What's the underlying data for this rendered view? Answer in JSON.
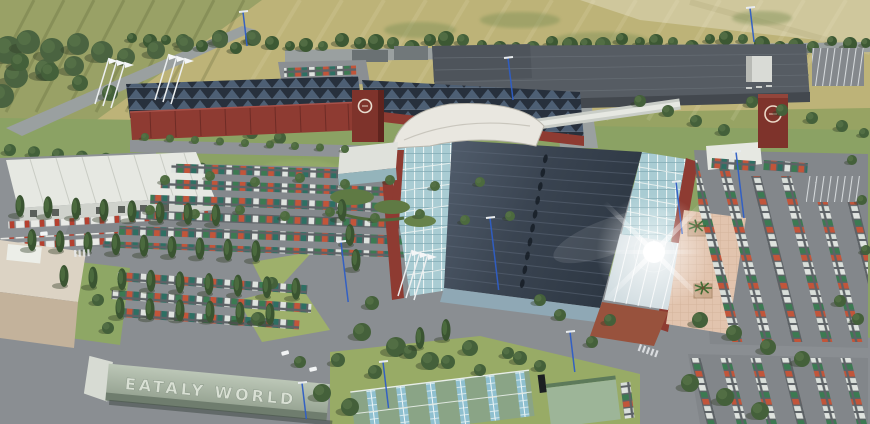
{
  "scene": {
    "sign": {
      "text": "EATALY WORLD"
    },
    "branding": {
      "tower_logo_left": "circular-ring-logo",
      "tower_logo_right": "circular-ring-logo"
    },
    "palette": {
      "field_yellow": "#bdb378",
      "field_pale": "#cfc79c",
      "field_olive": "#99a166",
      "grass": "#8ba264",
      "tree_dark": "#3f5a35",
      "road_gray": "#8a8e92",
      "parking_gray": "#84888c",
      "main_roof_dark": "#38424f",
      "sawtooth_roof": "#27303c",
      "glass_blue": "#a9ccd3",
      "brick_red": "#8e3b32",
      "white_building": "#e6e8e2",
      "plaza_pink": "#e2c4ae",
      "sign_slab_green": "#aebcab",
      "lamp_blue": "#2f5ec6",
      "car_white": "#dfe3df",
      "car_green": "#3c7a52",
      "car_red": "#c2553a"
    }
  }
}
